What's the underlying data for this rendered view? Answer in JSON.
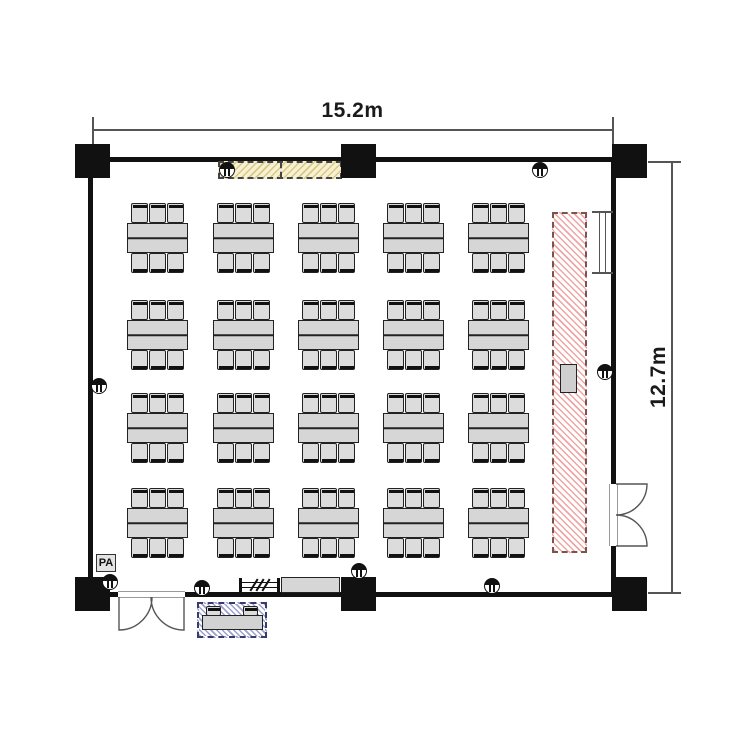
{
  "dimensions": {
    "width_label": "15.2m",
    "height_label": "12.7m"
  },
  "labels": {
    "pa": "PA"
  },
  "colors": {
    "wall": "#111111",
    "outline": "#222222",
    "table_fill": "#d6d6d6",
    "chair_fill": "#dcdcdc",
    "stage_hatch": "#f0a4a4",
    "stage_border": "#7d534b",
    "screen_fill": "#f8f1cf",
    "screen_hatch": "#c3b269",
    "reception_hatch": "#9aa1d0",
    "reception_border": "#3a3a6e",
    "dimension_line": "#555555",
    "text": "#1a1a1a"
  },
  "floorplan": {
    "table_groups": {
      "cols_x": [
        127,
        213,
        298,
        383,
        468
      ],
      "rows_y": [
        223,
        320,
        413,
        508
      ],
      "table_width": 61,
      "table_height": 30,
      "chairs_per_side": 3,
      "chair_offsets_x": [
        4,
        22,
        40
      ],
      "chair_width": 17,
      "chair_height": 20
    },
    "wall_lights": [
      {
        "x": 227,
        "y": 170
      },
      {
        "x": 540,
        "y": 170
      },
      {
        "x": 99,
        "y": 386
      },
      {
        "x": 605,
        "y": 372
      },
      {
        "x": 110,
        "y": 582
      },
      {
        "x": 202,
        "y": 588
      },
      {
        "x": 359,
        "y": 571
      },
      {
        "x": 492,
        "y": 586
      }
    ],
    "counts": {
      "table_groups": 20,
      "seats_per_group": 6,
      "total_seats": 120
    }
  }
}
